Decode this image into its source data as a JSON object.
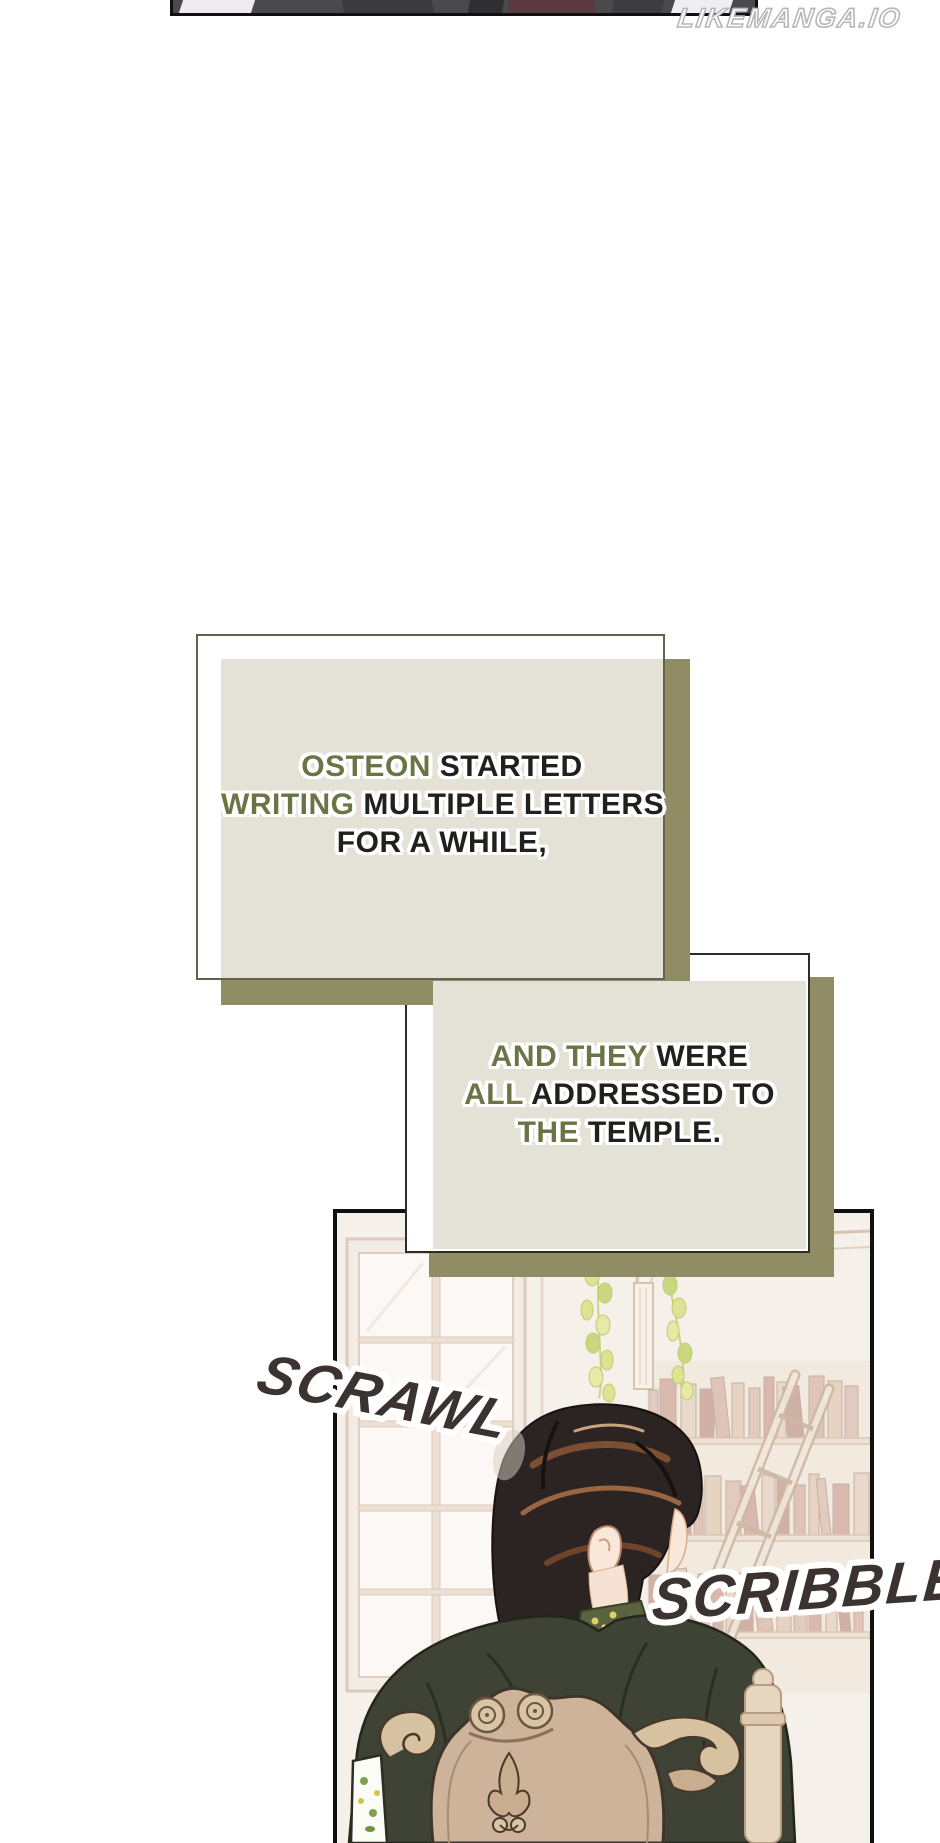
{
  "watermark": {
    "text": "LIKEMANGA.IO"
  },
  "narration1": {
    "line1_accent": "OSTEON",
    "line1_rest": " STARTED",
    "line2_accent": "WRITING",
    "line2_rest": " MULTIPLE LETTERS",
    "line3_rest": "FOR A WHILE,"
  },
  "narration2": {
    "line1_accent": "AND THEY",
    "line1_rest": " WERE",
    "line2_accent": "ALL",
    "line2_rest": " ADDRESSED TO",
    "line3_accent": "THE",
    "line3_rest": " TEMPLE."
  },
  "sfx": {
    "left": "SCRAWL",
    "right": "SCRIBBLE"
  },
  "theme": {
    "page_bg": "#ffffff",
    "narration_fill_tan": "#e4e2d7",
    "narration_shadow_khaki": "#908c63",
    "box1_border_olive": "#63634d",
    "box2_border_dark": "#2d2d27",
    "narration_accent_green": "#6b7444",
    "narration_text_dark": "#20201e",
    "panel_border_black": "#111111",
    "sfx_color": "#3a3330",
    "watermark_gray": "#b6b6b6",
    "wall_beige": "#f6f0ea",
    "jacket_green": "#3f4336",
    "chair_wood_tan": "#ccb399",
    "hair_dark_brown": "#2b2422",
    "plant_green": "#d9e18f",
    "top_strip_gray": "#4a4a4e",
    "top_strip_maroon": "#5c383f"
  }
}
